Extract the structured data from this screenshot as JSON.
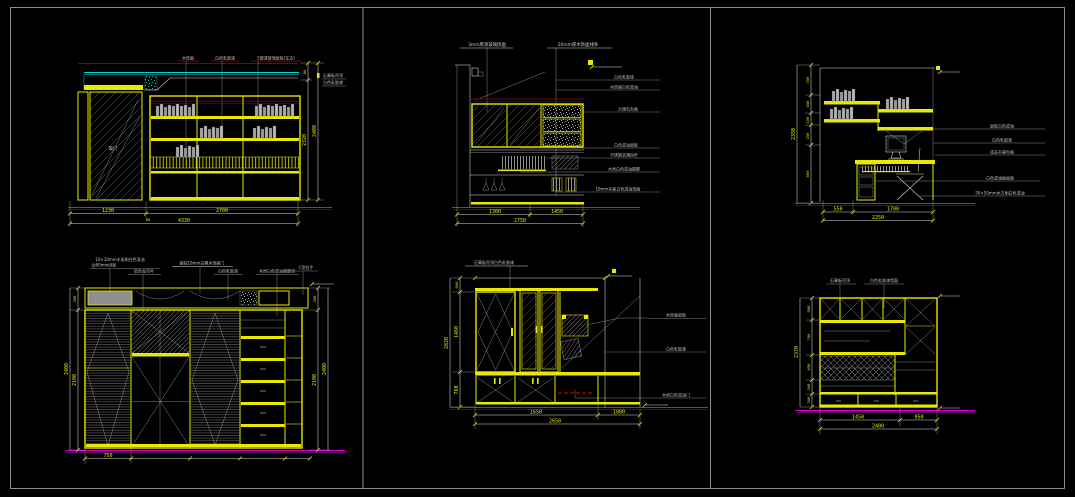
{
  "canvas": {
    "background": "#000000",
    "frame_color": "#8c8c8c",
    "accent_yellow": "#e8e800",
    "accent_cyan": "#00d4d4",
    "accent_magenta": "#cf00cf",
    "accent_red": "#b00000"
  },
  "panels": {
    "p1": {
      "name": "书柜立面图",
      "top_labels": [
        "木饰面",
        "白色乳胶漆",
        "5厘清玻璃层板(车边)"
      ],
      "door": "玻门",
      "side_note1": "石膏板吊顶",
      "side_note2": "白色乳胶漆",
      "dims": {
        "w1": "1230",
        "gap": "80",
        "w2": "2700",
        "w_total": "4330",
        "h_top": "80",
        "h_main": "2320",
        "h_total": "2400"
      }
    },
    "p2": {
      "name": "衣柜立面图",
      "top_labels": [
        "3mm厚清玻璃饰面",
        "20mm厚木饰面线条"
      ],
      "right_labels": [
        "白色乳胶漆",
        "木饰面白色混油",
        "大理石台面",
        "白色混油层板",
        "不锈钢衣通吊杆",
        "木质白色混油踢脚",
        "18mm夹板白色混油饰面"
      ],
      "dims": {
        "w1": "1300",
        "w2": "1450",
        "w_total": "2750"
      }
    },
    "p3": {
      "name": "书桌立面图",
      "right_labels": [
        "层板白色混油",
        "白色乳胶漆",
        "成品书桌台面",
        "白色混油抽屉面",
        "50×50mm木方刷白色混油"
      ],
      "dims": {
        "h_segs": [
          "350",
          "450",
          "100",
          "250",
          "800"
        ],
        "h_total": "2350",
        "w1": "550",
        "w2": "1700",
        "w_total": "2250"
      }
    },
    "p4": {
      "name": "衣柜立面图二",
      "top_labels": [
        "10×30mm木条刷白色混油",
        "@60mm间距",
        "铝合金百叶",
        "面贴18mm白橡木饰面门",
        "白色乳胶漆",
        "木质白色混油踢脚线",
        "C型拉手"
      ],
      "dims": {
        "w1": "750",
        "left_top": "300",
        "left_main": "2100",
        "left_total": "2400",
        "right_top": "300",
        "right_main": "2100",
        "right_total": "2400"
      }
    },
    "p5": {
      "name": "柜体立面图",
      "top_label": "石膏板吊顶白色乳胶漆",
      "right_labels": [
        "木饰面层板",
        "白色乳胶漆",
        "木质白色混油门"
      ],
      "dims": {
        "h_top": "600",
        "h1": "1460",
        "h2": "760",
        "h_total": "2820",
        "w1": "1650",
        "w2": "1000",
        "w_total": "2650"
      }
    },
    "p6": {
      "name": "柜体立面图二",
      "top_labels": [
        "石膏板吊顶",
        "白色乳胶漆墙面"
      ],
      "dims": {
        "h_segs": [
          "580",
          "700",
          "450",
          "340",
          "300"
        ],
        "h_total": "2370",
        "w1": "1450",
        "w2": "950",
        "w_total": "2400"
      }
    }
  }
}
